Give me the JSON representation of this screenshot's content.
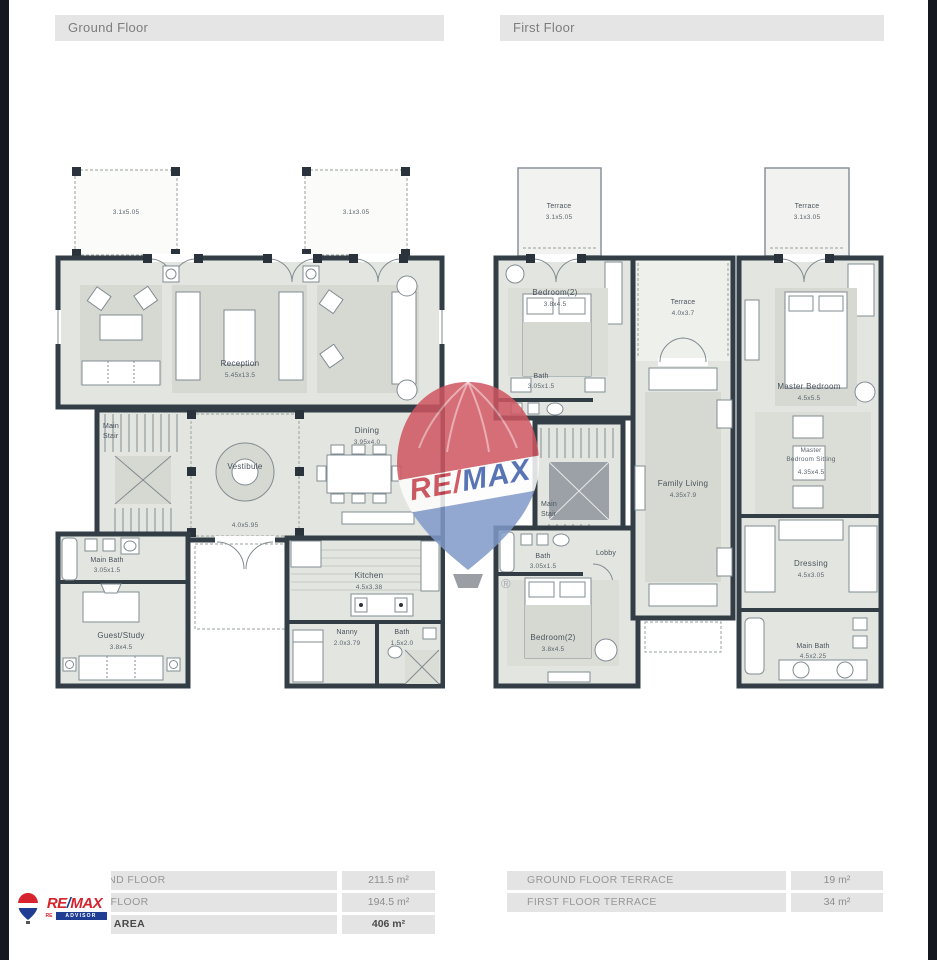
{
  "headers": {
    "ground": "Ground Floor",
    "first": "First Floor"
  },
  "ground_floor": {
    "terrace_left_dims": "3.1x5.05",
    "terrace_right_dims": "3.1x3.05",
    "reception": {
      "name": "Reception",
      "dims": "5.45x13.5"
    },
    "main_stair": {
      "line1": "Main",
      "line2": "Stair"
    },
    "vestibule": {
      "name": "Vestibule",
      "dims": "4.0x5.95"
    },
    "dining": {
      "name": "Dining",
      "dims": "3.95x4.0"
    },
    "main_bath": {
      "name": "Main Bath",
      "dims": "3.05x1.5"
    },
    "guest_study": {
      "name": "Guest/Study",
      "dims": "3.8x4.5"
    },
    "kitchen": {
      "name": "Kitchen",
      "dims": "4.5x3.38"
    },
    "nanny": {
      "name": "Nanny",
      "dims": "2.0x3.79"
    },
    "bath": {
      "name": "Bath",
      "dims": "1.5x2.0"
    }
  },
  "first_floor": {
    "terrace_left": {
      "name": "Terrace",
      "dims": "3.1x5.05"
    },
    "terrace_right": {
      "name": "Terrace",
      "dims": "3.1x3.05"
    },
    "bedroom2_top": {
      "name": "Bedroom(2)",
      "dims": "3.8x4.5"
    },
    "bath_top": {
      "name": "Bath",
      "dims": "3.05x1.5"
    },
    "terrace_center": {
      "name": "Terrace",
      "dims": "4.0x3.7"
    },
    "master_bedroom": {
      "name": "Master Bedroom",
      "dims": "4.5x5.5"
    },
    "master_sitting": {
      "line1": "Master",
      "line2": "Bedroom Sitting",
      "dims": "4.35x4.5"
    },
    "family_living": {
      "name": "Family Living",
      "dims": "4.35x7.9"
    },
    "main_stair": {
      "line1": "Main",
      "line2": "Stair"
    },
    "bath_mid": {
      "name": "Bath",
      "dims": "3.05x1.5"
    },
    "lobby": {
      "name": "Lobby"
    },
    "bedroom2_bottom": {
      "name": "Bedroom(2)",
      "dims": "3.8x4.5"
    },
    "dressing": {
      "name": "Dressing",
      "dims": "4.5x3.05"
    },
    "main_bath": {
      "name": "Main Bath",
      "dims": "4.5x2.25"
    }
  },
  "tables": {
    "left": {
      "rows": [
        {
          "label": "GROUND FLOOR",
          "value": "211.5 m²"
        },
        {
          "label": "FIRST FLOOR",
          "value": "194.5 m²"
        },
        {
          "label": "TOTAL AREA",
          "value": "406 m²"
        }
      ]
    },
    "right": {
      "rows": [
        {
          "label": "GROUND FLOOR TERRACE",
          "value": "19 m²"
        },
        {
          "label": "FIRST FLOOR TERRACE",
          "value": "34 m²"
        }
      ]
    }
  },
  "watermark": {
    "re": "RE",
    "slash": "/",
    "max": "MAX",
    "registered": "®",
    "red": "#c9404c",
    "blue": "#3b5ca8"
  },
  "logo": {
    "re": "RE",
    "slash": "/",
    "max": "MAX",
    "sub": "ADVISOR",
    "red": "#d6232e",
    "blue": "#1f3e93"
  }
}
